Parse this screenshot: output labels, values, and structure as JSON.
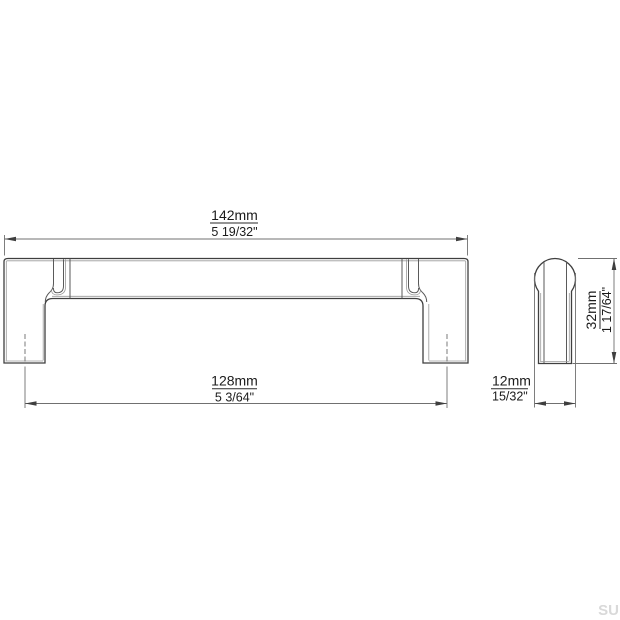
{
  "background": "#ffffff",
  "drawing": {
    "kind": "technical dimension drawing",
    "subject": "furniture pull handle",
    "front_view": {
      "overall_length": {
        "metric": "142mm",
        "imperial": "5 19/32\""
      },
      "mounting_hole_spacing": {
        "metric": "128mm",
        "imperial": "5 3/64\""
      }
    },
    "side_view": {
      "height": {
        "metric": "32mm",
        "imperial": "1 17/64\""
      },
      "depth": {
        "metric": "12mm",
        "imperial": "15/32\""
      }
    },
    "watermark": "SU",
    "colors": {
      "outline": "#3f3f3f",
      "detail_line": "#5a5a5a",
      "highlight_line": "#9a9a9a",
      "dimension_line": "#707070",
      "text": "#1b1b1b",
      "watermark": "#d9d9d9"
    }
  }
}
